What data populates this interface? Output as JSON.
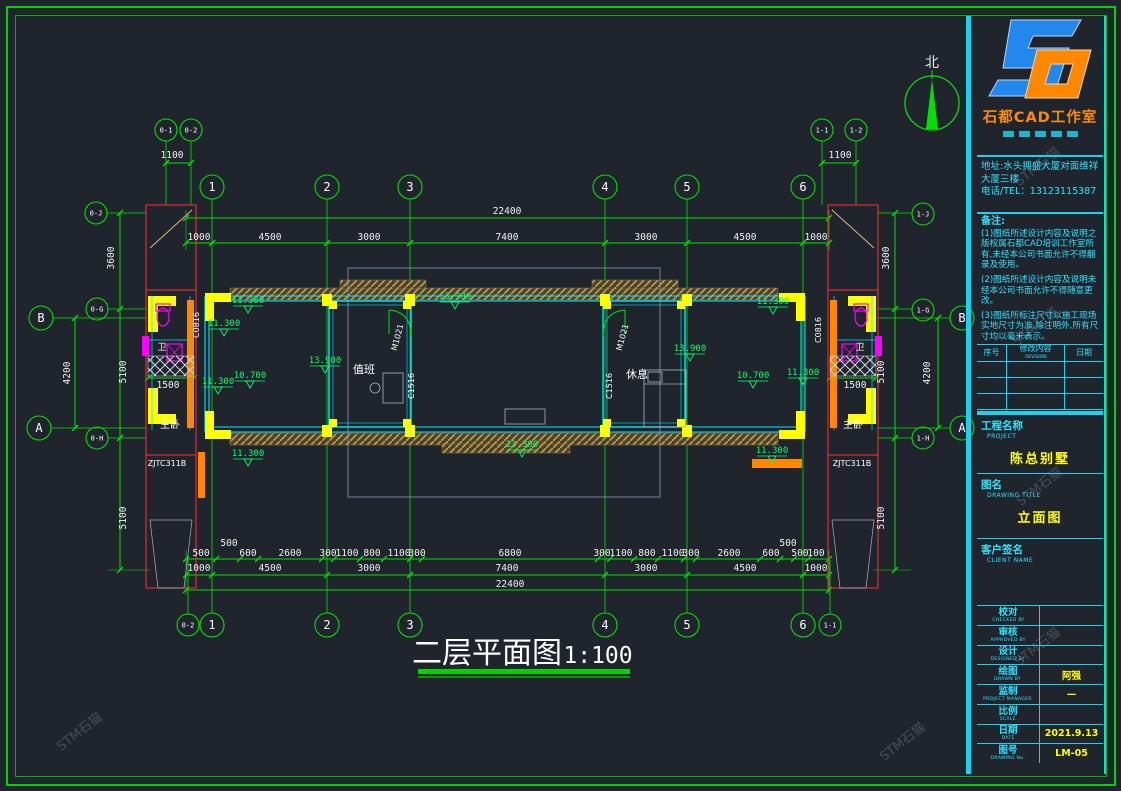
{
  "sheet": {
    "bg": "#20252d",
    "line_green": "#00e000",
    "line_cyan": "#19d2f0",
    "accent_yellow": "#ffff00"
  },
  "watermark": "STM石猫",
  "title_block": {
    "logo": {
      "company": "石都CAD工作室",
      "monogram": "SD"
    },
    "address_lines": [
      "地址:水头拥盛大厦对面维祥",
      "大厦三楼",
      "电话/TEL：13123115387"
    ],
    "notes_title": "备注:",
    "notes": [
      "(1)图纸所述设计内容及说明之版权属石都CAD培训工作室所有,未经本公司书面允许不得翻录及使用。",
      "(2)图纸所述设计内容及说明未经本公司书面允许不得随意更改。",
      "(3)图纸所标注尺寸以施工现场实地尺寸为准,除注明外,所有尺寸均以毫米表示。"
    ],
    "rev_table": {
      "headers": [
        "序号",
        "修改内容",
        "日期"
      ],
      "header_sub": "REVISION"
    },
    "project": {
      "label_cn": "工程名称",
      "label_en": "PROJECT",
      "value": "陈总别墅"
    },
    "drawing_title": {
      "label_cn": "图名",
      "label_en": "DRAWING TITLE",
      "value": "立面图"
    },
    "client": {
      "label_cn": "客户签名",
      "label_en": "CLIENT NAME",
      "value": ""
    },
    "fields": [
      {
        "cn": "校对",
        "en": "CHECKED BY",
        "value": ""
      },
      {
        "cn": "审核",
        "en": "APPROVED BY",
        "value": ""
      },
      {
        "cn": "设计",
        "en": "DESIGNED BY",
        "value": ""
      },
      {
        "cn": "绘图",
        "en": "DRAWN BY",
        "value": "阿强"
      },
      {
        "cn": "监制",
        "en": "PROJECT MANAGER",
        "value": "—"
      },
      {
        "cn": "比例",
        "en": "SCALE",
        "value": ""
      },
      {
        "cn": "日期",
        "en": "DATE",
        "value": "2021.9.13"
      },
      {
        "cn": "图号",
        "en": "DRAWING No.",
        "value": "LM-05"
      }
    ]
  },
  "drawing": {
    "title": "二层平面图",
    "scale": "1:100",
    "north_label": "北",
    "grid_bubbles": [
      {
        "t": "1",
        "x": 212,
        "y": 187
      },
      {
        "t": "2",
        "x": 327,
        "y": 187
      },
      {
        "t": "3",
        "x": 410,
        "y": 187
      },
      {
        "t": "4",
        "x": 605,
        "y": 187
      },
      {
        "t": "5",
        "x": 687,
        "y": 187
      },
      {
        "t": "6",
        "x": 803,
        "y": 187
      },
      {
        "t": "1",
        "x": 212,
        "y": 625
      },
      {
        "t": "2",
        "x": 327,
        "y": 625
      },
      {
        "t": "3",
        "x": 410,
        "y": 625
      },
      {
        "t": "4",
        "x": 605,
        "y": 625
      },
      {
        "t": "5",
        "x": 687,
        "y": 625
      },
      {
        "t": "6",
        "x": 803,
        "y": 625
      },
      {
        "t": "0-1",
        "x": 166,
        "y": 130,
        "r": 11,
        "fs": 7
      },
      {
        "t": "0-2",
        "x": 191,
        "y": 130,
        "r": 11,
        "fs": 7
      },
      {
        "t": "1-1",
        "x": 822,
        "y": 130,
        "r": 11,
        "fs": 7
      },
      {
        "t": "1-2",
        "x": 856,
        "y": 130,
        "r": 11,
        "fs": 7
      },
      {
        "t": "0-2",
        "x": 188,
        "y": 625,
        "r": 11,
        "fs": 7
      },
      {
        "t": "1-1",
        "x": 830,
        "y": 625,
        "r": 11,
        "fs": 7
      },
      {
        "t": "B",
        "x": 41,
        "y": 318
      },
      {
        "t": "A",
        "x": 39,
        "y": 428
      },
      {
        "t": "B",
        "x": 962,
        "y": 318
      },
      {
        "t": "A",
        "x": 962,
        "y": 428
      },
      {
        "t": "0-J",
        "x": 96,
        "y": 213,
        "r": 11,
        "fs": 7
      },
      {
        "t": "0-G",
        "x": 97,
        "y": 309,
        "r": 11,
        "fs": 7
      },
      {
        "t": "0-H",
        "x": 97,
        "y": 438,
        "r": 11,
        "fs": 7
      },
      {
        "t": "1-J",
        "x": 923,
        "y": 214,
        "r": 11,
        "fs": 7
      },
      {
        "t": "1-G",
        "x": 923,
        "y": 310,
        "r": 11,
        "fs": 7
      },
      {
        "t": "1-H",
        "x": 923,
        "y": 438,
        "r": 11,
        "fs": 7
      }
    ],
    "dim_labels": [
      {
        "t": "1100",
        "x": 172,
        "y": 158
      },
      {
        "t": "1100",
        "x": 840,
        "y": 158
      },
      {
        "t": "22400",
        "x": 507,
        "y": 214
      },
      {
        "t": "1000",
        "x": 199,
        "y": 240
      },
      {
        "t": "4500",
        "x": 270,
        "y": 240
      },
      {
        "t": "3000",
        "x": 369,
        "y": 240
      },
      {
        "t": "7400",
        "x": 507,
        "y": 240
      },
      {
        "t": "3000",
        "x": 646,
        "y": 240
      },
      {
        "t": "4500",
        "x": 745,
        "y": 240
      },
      {
        "t": "1000",
        "x": 816,
        "y": 240
      },
      {
        "t": "500",
        "x": 201,
        "y": 556
      },
      {
        "t": "500",
        "x": 229,
        "y": 546
      },
      {
        "t": "600",
        "x": 248,
        "y": 556
      },
      {
        "t": "2600",
        "x": 290,
        "y": 556
      },
      {
        "t": "300",
        "x": 328,
        "y": 556
      },
      {
        "t": "1100",
        "x": 347,
        "y": 556
      },
      {
        "t": "800",
        "x": 372,
        "y": 556
      },
      {
        "t": "1100",
        "x": 399,
        "y": 556
      },
      {
        "t": "300",
        "x": 417,
        "y": 556
      },
      {
        "t": "6800",
        "x": 510,
        "y": 556
      },
      {
        "t": "300",
        "x": 602,
        "y": 556
      },
      {
        "t": "1100",
        "x": 621,
        "y": 556
      },
      {
        "t": "800",
        "x": 647,
        "y": 556
      },
      {
        "t": "1100",
        "x": 673,
        "y": 556
      },
      {
        "t": "300",
        "x": 691,
        "y": 556
      },
      {
        "t": "2600",
        "x": 729,
        "y": 556
      },
      {
        "t": "600",
        "x": 771,
        "y": 556
      },
      {
        "t": "500",
        "x": 788,
        "y": 546
      },
      {
        "t": "500",
        "x": 800,
        "y": 556
      },
      {
        "t": "100",
        "x": 816,
        "y": 556
      },
      {
        "t": "1000",
        "x": 199,
        "y": 571
      },
      {
        "t": "4500",
        "x": 270,
        "y": 571
      },
      {
        "t": "3000",
        "x": 369,
        "y": 571
      },
      {
        "t": "7400",
        "x": 507,
        "y": 571
      },
      {
        "t": "3000",
        "x": 646,
        "y": 571
      },
      {
        "t": "4500",
        "x": 745,
        "y": 571
      },
      {
        "t": "1000",
        "x": 816,
        "y": 571
      },
      {
        "t": "22400",
        "x": 510,
        "y": 587
      },
      {
        "t": "3600",
        "x": 114,
        "y": 258,
        "rot": -90
      },
      {
        "t": "5100",
        "x": 126,
        "y": 372,
        "rot": -90
      },
      {
        "t": "4200",
        "x": 70,
        "y": 373,
        "rot": -90
      },
      {
        "t": "5100",
        "x": 126,
        "y": 518,
        "rot": -90
      },
      {
        "t": "3600",
        "x": 889,
        "y": 258,
        "rot": -90
      },
      {
        "t": "5100",
        "x": 884,
        "y": 372,
        "rot": -90
      },
      {
        "t": "4200",
        "x": 930,
        "y": 373,
        "rot": -90
      },
      {
        "t": "5100",
        "x": 884,
        "y": 518,
        "rot": -90
      },
      {
        "t": "1500",
        "x": 168,
        "y": 388
      },
      {
        "t": "1500",
        "x": 855,
        "y": 388
      }
    ],
    "elevations": [
      {
        "t": "13.900",
        "x": 455,
        "y": 299
      },
      {
        "t": "13.900",
        "x": 325,
        "y": 363
      },
      {
        "t": "13.900",
        "x": 690,
        "y": 351
      },
      {
        "t": "10.700",
        "x": 250,
        "y": 378
      },
      {
        "t": "10.700",
        "x": 753,
        "y": 378
      },
      {
        "t": "11.300",
        "x": 248,
        "y": 303
      },
      {
        "t": "11.300",
        "x": 224,
        "y": 326
      },
      {
        "t": "11.300",
        "x": 218,
        "y": 384
      },
      {
        "t": "11.300",
        "x": 248,
        "y": 456
      },
      {
        "t": "11.300",
        "x": 773,
        "y": 304
      },
      {
        "t": "11.300",
        "x": 803,
        "y": 375
      },
      {
        "t": "11.300",
        "x": 772,
        "y": 453
      },
      {
        "t": "13.300",
        "x": 522,
        "y": 447
      }
    ],
    "labels": [
      {
        "t": "值班",
        "x": 364,
        "y": 373,
        "fs": 11,
        "fill": "#ffffff"
      },
      {
        "t": "休息",
        "x": 637,
        "y": 378,
        "fs": 11,
        "fill": "#ffffff"
      },
      {
        "t": "主卧",
        "x": 170,
        "y": 428,
        "fs": 10,
        "fill": "#ffffff"
      },
      {
        "t": "主卧",
        "x": 853,
        "y": 428,
        "fs": 10,
        "fill": "#ffffff"
      },
      {
        "t": "卫",
        "x": 162,
        "y": 350,
        "fs": 9,
        "fill": "#ffffff"
      },
      {
        "t": "卫",
        "x": 860,
        "y": 350,
        "fs": 9,
        "fill": "#ffffff"
      },
      {
        "t": "ZJTC311B",
        "x": 167,
        "y": 466,
        "fs": 8,
        "fill": "#ffffff"
      },
      {
        "t": "ZJTC311B",
        "x": 852,
        "y": 466,
        "fs": 8,
        "fill": "#ffffff"
      },
      {
        "t": "C0816",
        "x": 199,
        "y": 325,
        "fs": 8,
        "rot": -90,
        "fill": "#ffffff"
      },
      {
        "t": "C0816",
        "x": 821,
        "y": 330,
        "fs": 8,
        "rot": -90,
        "fill": "#ffffff"
      },
      {
        "t": "C1516",
        "x": 414,
        "y": 386,
        "fs": 8,
        "rot": -90,
        "fill": "#ffffff"
      },
      {
        "t": "C1516",
        "x": 612,
        "y": 386,
        "fs": 8,
        "rot": -90,
        "fill": "#ffffff"
      },
      {
        "t": "M1021",
        "x": 400,
        "y": 338,
        "fs": 8,
        "rot": -75,
        "fill": "#ffffff"
      },
      {
        "t": "M1021",
        "x": 625,
        "y": 338,
        "fs": 8,
        "rot": -75,
        "fill": "#ffffff"
      }
    ]
  }
}
